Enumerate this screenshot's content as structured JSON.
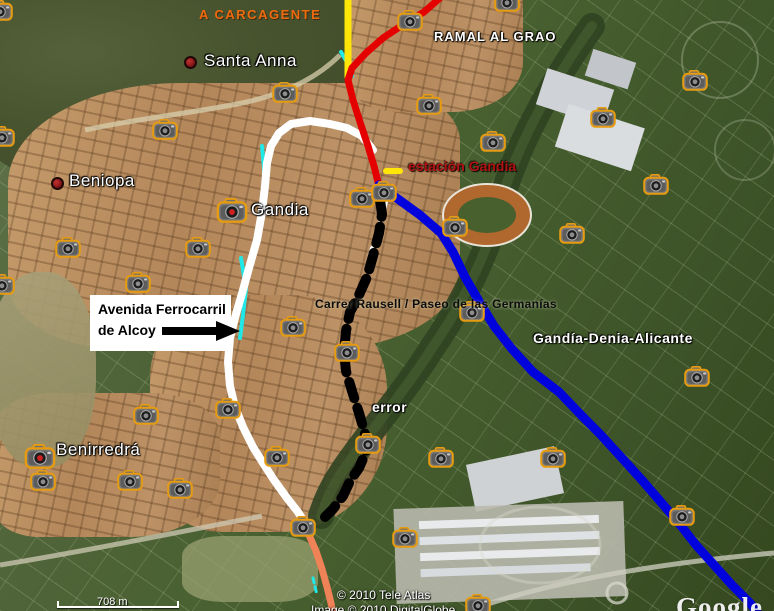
{
  "annotation_box": {
    "line1": "Avenida Ferrocarril",
    "line2": "de Alcoy"
  },
  "labels": [
    {
      "id": "a-carcagente",
      "text": "A CARCAGENTE",
      "x": 199,
      "y": 7,
      "cls": "lbl-carcagente"
    },
    {
      "id": "santa-anna",
      "text": "Santa Anna",
      "x": 204,
      "y": 51,
      "cls": "lbl-place",
      "dot": {
        "x": 184,
        "y": 56
      }
    },
    {
      "id": "ramal-al-grao",
      "text": "RAMAL AL GRAO",
      "x": 434,
      "y": 29,
      "cls": "lbl-route"
    },
    {
      "id": "beniopa",
      "text": "Beniopa",
      "x": 69,
      "y": 171,
      "cls": "lbl-place",
      "dot": {
        "x": 51,
        "y": 177
      }
    },
    {
      "id": "gandia",
      "text": "Gandia",
      "x": 251,
      "y": 200,
      "cls": "lbl-place"
    },
    {
      "id": "estacion-gandia",
      "text": "estación Gandia",
      "x": 408,
      "y": 158,
      "cls": "lbl-station"
    },
    {
      "id": "carrer-rausell",
      "text": "Carrer Rausell / Paseo de las Germanías",
      "x": 315,
      "y": 297,
      "cls": "lbl-street"
    },
    {
      "id": "gandia-denia-alicante",
      "text": "Gandía-Denia-Alicante",
      "x": 533,
      "y": 330,
      "cls": "lbl-route2"
    },
    {
      "id": "error",
      "text": "error",
      "x": 372,
      "y": 399,
      "cls": "lbl-route2"
    },
    {
      "id": "benirredra",
      "text": "Benirredrá",
      "x": 56,
      "y": 440,
      "cls": "lbl-place"
    }
  ],
  "lines": [
    {
      "name": "cyan-upper",
      "color": "#21e8e8",
      "width": 4,
      "points": "341,52 348,64 352,76"
    },
    {
      "name": "cyan-west",
      "color": "#21e8e8",
      "width": 4,
      "points": "262,146 264,168 264,188"
    },
    {
      "name": "cyan-mid",
      "color": "#21e8e8",
      "width": 4,
      "points": "241,258 246,288 243,315 240,338"
    },
    {
      "name": "cyan-south",
      "color": "#21e8e8",
      "width": 3,
      "dash": "5 4",
      "points": "313,578 317,595"
    },
    {
      "name": "white-dashed",
      "color": "#ffffff",
      "width": 4,
      "dash": "8 8",
      "points": "386,202 380,224 372,248 368,262"
    },
    {
      "name": "white-avenida",
      "color": "#ffffff",
      "width": 8,
      "points": "373,150 362,136 347,128 330,124 310,121 291,124 279,133 271,146 267,163 265,186 262,212 257,240 249,268 243,290 236,314 230,338 228,362 230,386 235,407 243,427 253,447 263,463 274,480 287,498 298,512 303,520"
    },
    {
      "name": "yellow-carcagente",
      "color": "#ffe608",
      "width": 7,
      "points": "348,-4 348,77"
    },
    {
      "name": "yellow-station-dash",
      "color": "#ffe608",
      "width": 6,
      "points": "386,171 400,171"
    },
    {
      "name": "red-ramal",
      "color": "#e40000",
      "width": 7,
      "points": "441,-3 424,12 404,24 383,38 366,53 352,68 348,80 353,100 360,122 368,146 374,166 378,182"
    },
    {
      "name": "black-dashed-error",
      "color": "#000000",
      "width": 10,
      "dash": "17 10",
      "points": "380,200 382,214 379,233 373,256 367,277 359,295 350,312 346,331 344,352 346,371 352,391 359,413 365,434 366,452 359,468 350,481 343,496 333,509 325,517"
    },
    {
      "name": "orange-south",
      "color": "#ef8257",
      "width": 7,
      "points": "303,520 309,535 316,551 322,569 327,587 331,603 333,614"
    },
    {
      "name": "blue-gandia-denia",
      "color": "#0202dd",
      "width": 9,
      "points": "379,185 398,199 420,215 441,233 453,252 465,277 480,303 494,326 512,349 533,372 559,392 582,416 600,434 621,457 641,479 660,501 678,522 696,545 714,565 732,585 750,603 758,614"
    }
  ],
  "cameras": [
    {
      "x": 0,
      "y": 11
    },
    {
      "x": 285,
      "y": 93
    },
    {
      "x": 165,
      "y": 130
    },
    {
      "x": 2,
      "y": 137
    },
    {
      "x": 410,
      "y": 21
    },
    {
      "x": 507,
      "y": 2
    },
    {
      "x": 429,
      "y": 105
    },
    {
      "x": 493,
      "y": 142
    },
    {
      "x": 603,
      "y": 118
    },
    {
      "x": 695,
      "y": 81
    },
    {
      "x": 656,
      "y": 185
    },
    {
      "x": 362,
      "y": 198
    },
    {
      "x": 384,
      "y": 192
    },
    {
      "x": 455,
      "y": 227
    },
    {
      "x": 572,
      "y": 234
    },
    {
      "x": 232,
      "y": 211,
      "red": true
    },
    {
      "x": 68,
      "y": 248
    },
    {
      "x": 198,
      "y": 248
    },
    {
      "x": 138,
      "y": 283
    },
    {
      "x": 2,
      "y": 285
    },
    {
      "x": 293,
      "y": 327
    },
    {
      "x": 347,
      "y": 352
    },
    {
      "x": 472,
      "y": 312
    },
    {
      "x": 697,
      "y": 377
    },
    {
      "x": 146,
      "y": 415
    },
    {
      "x": 228,
      "y": 409
    },
    {
      "x": 368,
      "y": 444
    },
    {
      "x": 40,
      "y": 457,
      "red": true
    },
    {
      "x": 43,
      "y": 481
    },
    {
      "x": 130,
      "y": 481
    },
    {
      "x": 180,
      "y": 489
    },
    {
      "x": 277,
      "y": 457
    },
    {
      "x": 441,
      "y": 458
    },
    {
      "x": 553,
      "y": 458
    },
    {
      "x": 303,
      "y": 527
    },
    {
      "x": 405,
      "y": 538
    },
    {
      "x": 682,
      "y": 516
    },
    {
      "x": 478,
      "y": 605
    }
  ],
  "footer": {
    "attribution_line1": "© 2010 Tele Atlas",
    "attribution_line2": "Image © 2010 DigitalGlobe",
    "scale_label": "708 m",
    "watermark": "Google"
  }
}
